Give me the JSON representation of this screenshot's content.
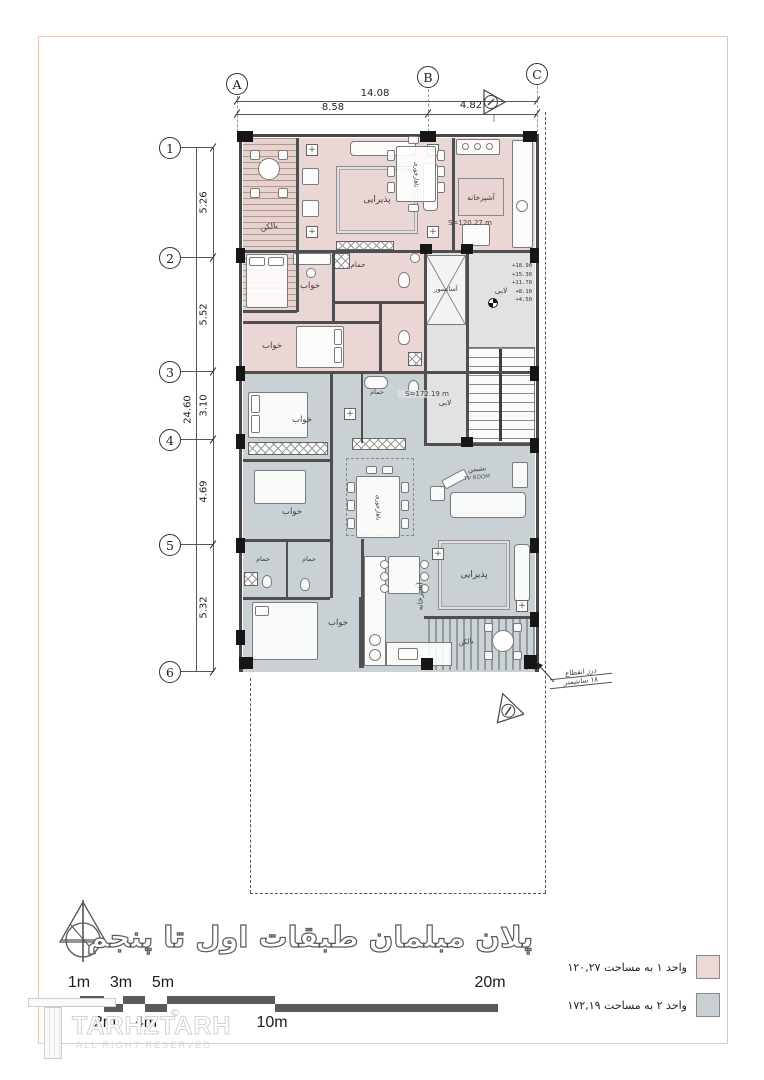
{
  "grid": {
    "cols": [
      "A",
      "B",
      "C"
    ],
    "rows": [
      "1",
      "2",
      "3",
      "4",
      "5",
      "6"
    ],
    "top_dims": {
      "overall": "14.08",
      "a_b": "8.58",
      "b_c": "4.82"
    },
    "left_dims": {
      "overall": "24.60",
      "r1_r2": "5.26",
      "r2_r3": "5.52",
      "r3_r4": "3.10",
      "r4_r5": "4.69",
      "r5_r6": "5.32"
    }
  },
  "plan": {
    "unit1_area": "S=120.27 m",
    "unit2_area": "S=172.19 m",
    "plus": "+",
    "rooms": {
      "balcony": "بالکن",
      "living": "پذیرایی",
      "dining": "ناهارخوری",
      "kitchen": "آشپزخانه",
      "bedroom": "خواب",
      "bath": "حمام",
      "elevator": "آسانسور",
      "lobby": "لابی",
      "tv_fa": "نشیمن",
      "tv_en": "TV ROOM"
    },
    "levels": [
      "+18.90",
      "+15.30",
      "+11.70",
      "+8.10",
      "+4.50"
    ],
    "joint_note": {
      "line1": "درز انقطاع",
      "line2": "۱۸ سانتیمتر"
    }
  },
  "footer": {
    "title": "پلان مبلمان طبقات اول تا پنجم",
    "legend": [
      {
        "label": "واحد ۱ به مساحت ۱۲۰,۲۷",
        "color": "#ecd9d7"
      },
      {
        "label": "واحد ۲ به مساحت ۱۷۲,۱۹",
        "color": "#c9d1d5"
      }
    ],
    "scale": {
      "top": [
        "1m",
        "3m",
        "5m",
        "20m"
      ],
      "bottom": [
        "2m",
        "4m",
        "10m"
      ],
      "copyright": "©"
    },
    "watermark": {
      "name": "TARHZTARH",
      "sub": "ALL RIGHT RESERVED"
    }
  },
  "colors": {
    "unit1": "#ead7d5",
    "unit2": "#c9d1d5",
    "core": "#e0e2e3",
    "wall": "#4f4f4f"
  }
}
